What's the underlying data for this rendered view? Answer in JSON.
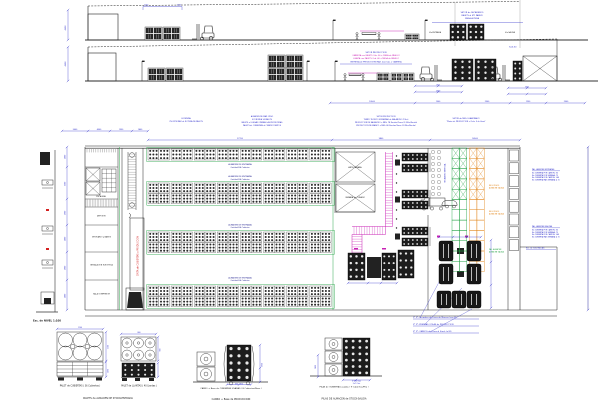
{
  "colors": {
    "line": "#3a3a3a",
    "dim": "#2828c8",
    "magenta": "#c820b4",
    "red": "#d42020",
    "green": "#1a9e3c",
    "orange": "#e08214",
    "dark_fill": "#1c1c1c"
  },
  "elev1": {
    "notes": [
      "SETOR de SECADEROS",
      "PALETS al MT. PARED",
      "MESA ALTURA"
    ],
    "dim_h": "4500",
    "stack_dim": "1100",
    "label_in": "Via ENTRADA",
    "label_out": "Via SALIDA"
  },
  "elev2": {
    "notes": [
      "SETOR PRODUCCION",
      "CARRETA con PALETS Cub. 36 + MESA de PASILLO",
      "LLANTA con PALETS Cub. 40 + MESA de PASILLO",
      "ENTREGA de PRODUCCION MAX. 2x4 Cub. x CARRETA"
    ],
    "dim_h": "4500",
    "h_note": "h=6.50",
    "dims": [
      "750",
      "1500",
      "900",
      "10500",
      "1500",
      "2300",
      "1250",
      "2500"
    ]
  },
  "plan": {
    "notes_a": [
      "LEYENDA",
      "750 MTS MAX de ROTURA DE PALETS"
    ],
    "notes_b": [
      "ALMACEN DE MAX. PESO",
      "ECONOMIA 14 PALETS",
      "PALETS al LLEGAR OPERAN LAS PRODUCIDAS",
      "PALETS de CUBIERTAS al CUATROCIENTOS"
    ],
    "notes_c": [
      "SETOR PRODUCCION",
      "TEMPO TEORICO ESTANDAR de BALANCEO (15hs)",
      "PRODUCCION DE BALANCEO x MES: 78 Ruedas/Turno (2,35hs/Rueda)",
      "PRODUCCION DE BIANCO x MES: 80 Ruedas/Turno (2,35hs/Rueda)"
    ],
    "notes_d": [
      "SETOR de MES. ELABORADO",
      "\"Motor de PRODUCCION x Ciclo: 3 de Hora\""
    ],
    "dims_top": [
      "5000",
      "4500",
      "1350",
      "1400",
      "27700",
      "9800",
      "14500"
    ],
    "dims_left": [
      "2000",
      "3300",
      "2500",
      "2800",
      "2900",
      "2800"
    ],
    "rooms": [
      "ESCALERA",
      "DEPOSITO",
      "VESTUARIO y BAÑOS",
      "INSTALACION ELECTRICA",
      "SALA COMPRESOR"
    ],
    "aisle_label": "ALMACEN DE ENTRADA",
    "aisle_sub": "Cantidad 504 Cubiertas",
    "cam1": "ANTECAMARA",
    "cam2": "CAMARA de CURADO",
    "conveyor_note": "CINTA de CUBIERTAS a PRODUCCION",
    "secadero_note": "SECADERO VERTICAL",
    "rack_note_1": [
      "REG. PESOS",
      "ALMACEN SALIDA"
    ],
    "rack_note_2": [
      "REG. PESOS",
      "ALMACEN SALIDA"
    ],
    "rack_note_3": [
      "PAL. ALMACEN",
      "ALMACEN SALIDA"
    ],
    "right_block_1": {
      "title": "PAL. ABIERTA (ENTRADA)",
      "lines": [
        "No CUBIERTA POR CAMION: 36",
        "No CUBIERTA POR SEMANA: 72",
        "No CUBIERTA POR CAMION: 144",
        "No CUBIERTA MAX SEMANA: 4 Tn"
      ]
    },
    "right_block_2": {
      "title": "PAL. ABIERTA (SALIDA)",
      "lines": [
        "No CUBIERTA POR CAMION: 36",
        "No CUBIERTA POR SEMANA: 72",
        "No CUBIERTA POR CAMION: 144",
        "No CUBIERTA MAX SEMANA: 4 Tn"
      ]
    },
    "right_note": "Esc. de Tons PALCAS",
    "leaders": [
      "1ª Fª: Secadero de Linea de Marcas (con B)",
      "2ª Fª: PRENSAS / PILAS de PRODUCCION",
      "3ª Fª: CARROS de Linea al Stock (al B)"
    ],
    "scale_note": "Esc. de NIVEL 1:100",
    "racks": {
      "bands": 4,
      "pallets_per_row": 16,
      "tires_per_pallet": 9
    }
  },
  "details": {
    "p1_label": "PALET de CUBIERTAS ( 36 Cubiertas )",
    "p2_label": "PALET de LLANTAS ( 40 Llantas )",
    "group12_label": "PALETS de ALMACEN DE STOCK-ENTRADA",
    "carro_label": "CARRO + Base de CUBIERTAS USADAS ( 8 Cubiertas/Base )",
    "carro_main": "CARRO + Base de PRODUCCION",
    "pilas_label": "PILAS de CUBIERTAS usadas ( 9 Cubiertas/Pila )",
    "pilas_main": "PILAS DE ALMACEN de STOCK-SALIDA",
    "dims": [
      "1100",
      "1100",
      "1460",
      "800",
      "900",
      "1750",
      "650 - 650",
      "Ø 650 max",
      "2+7 Cub.",
      "1800"
    ]
  }
}
